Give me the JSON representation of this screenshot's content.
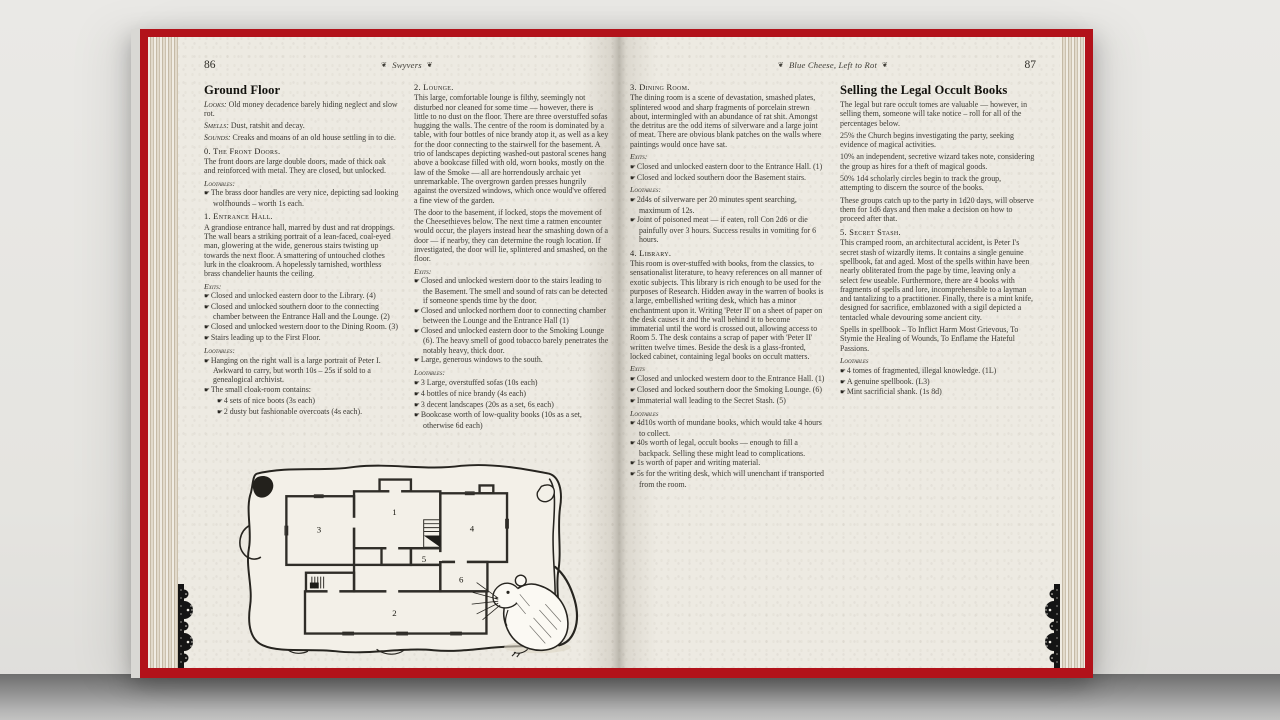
{
  "icons": {
    "bullet": "☛",
    "fleuron": "❦"
  },
  "colors": {
    "cover_red": "#b2121a",
    "paper": "#edeae2",
    "ink": "#3b3933"
  },
  "left_page": {
    "page_number": "86",
    "running_header": "Swyvers",
    "col1": {
      "heading": "Ground Floor",
      "stats": [
        {
          "label": "Looks:",
          "text": " Old money decadence barely hiding neglect and slow rot."
        },
        {
          "label": "Smells:",
          "text": " Dust, ratshit and decay."
        },
        {
          "label": "Sounds:",
          "text": " Creaks and moans of an old house settling in to die."
        }
      ],
      "section0": {
        "title": "0. The Front Doors.",
        "body": "The front doors are large double doors, made of thick oak and reinforced with metal. They are closed, but unlocked."
      },
      "loot0_label": "Lootables:",
      "loot0": [
        "The brass door handles are very nice, depicting sad looking wolfhounds – worth 1s each."
      ],
      "section1": {
        "title": "1. Entrance Hall.",
        "body": "A grandiose entrance hall, marred by dust and rat droppings. The wall bears a striking portrait of a lean-faced, coal-eyed man, glowering at the wide, generous stairs twisting up towards the next floor. A smattering of untouched clothes lurk in the cloakroom. A hopelessly tarnished, worthless brass chandelier haunts the ceiling."
      },
      "exits1_label": "Exits:",
      "exits1": [
        "Closed and unlocked eastern door to the Library. (4)",
        "Closed and unlocked southern door to the connecting chamber between the Entrance Hall and the Lounge. (2)",
        "Closed and unlocked western door to the Dining Room. (3)",
        "Stairs leading up to the First Floor."
      ],
      "loot1_label": "Lootables:",
      "loot1": [
        "Hanging on the right wall is a large portrait of Peter I. Awkward to carry, but worth 10s – 25s if sold to a genealogical archivist.",
        "The small cloak-room contains:"
      ],
      "loot1_sub": [
        "4 sets of nice boots (3s each)",
        "2 dusty but fashionable overcoats (4s each)."
      ]
    },
    "col2": {
      "section2": {
        "title": "2. Lounge.",
        "body1": "This large, comfortable lounge is filthy, seemingly not disturbed nor cleaned for some time — however, there is little to no dust on the floor. There are three overstuffed sofas hugging the walls. The centre of the room is dominated by a table, with four bottles of nice brandy atop it, as well as a key for the door connecting to the stairwell for the basement. A trio of landscapes depicting washed-out pastoral scenes hang above a bookcase filled with old, worn books, mostly on the law of the Smoke — all are horrendously archaic yet unremarkable. The overgrown garden presses hungrily against the oversized windows, which once would've offered a fine view of the garden.",
        "body2": "The door to the basement, if locked, stops the movement of the Cheesethieves below. The next time a ratmen encounter would occur, the players instead hear the smashing down of a door — if nearby, they can determine the rough location. If investigated, the door will lie, splintered and smashed, on the floor."
      },
      "exits2_label": "Exits:",
      "exits2": [
        "Closed and unlocked western door to the stairs leading to the Basement. The smell and sound of rats can be detected if someone spends time by the door.",
        "Closed and unlocked northern door to connecting chamber between the Lounge and the Entrance Hall (1)",
        "Closed and unlocked eastern door to the Smoking Lounge (6). The heavy smell of good tobacco barely penetrates the notably heavy, thick door.",
        "Large, generous windows to the south."
      ],
      "loot2_label": "Lootables:",
      "loot2": [
        "3 Large, overstuffed sofas (10s each)",
        "4 bottles of nice brandy (4s each)",
        "3 decent landscapes (20s as a set, 6s each)",
        "Bookcase worth of low-quality books (10s as a set, otherwise 6d each)"
      ]
    },
    "floorplan": {
      "rooms": [
        "1",
        "2",
        "3",
        "4",
        "5",
        "6"
      ]
    }
  },
  "right_page": {
    "page_number": "87",
    "running_header": "Blue Cheese, Left to Rot",
    "col1": {
      "section3": {
        "title": "3. Dining Room.",
        "body": "The dining room is a scene of devastation, smashed plates, splintered wood and sharp fragments of porcelain strewn about, intermingled with an abundance of rat shit. Amongst the detritus are the odd items of silverware and a large joint of meat. There are obvious blank patches on the walls where paintings would once have sat."
      },
      "exits3_label": "Exits:",
      "exits3": [
        "Closed and unlocked eastern door to the Entrance Hall. (1)",
        "Closed and locked southern door the Basement stairs."
      ],
      "loot3_label": "Lootables:",
      "loot3": [
        "2d4s of silverware per 20 minutes spent searching, maximum of 12s.",
        "Joint of poisoned meat — if eaten, roll Con 2d6 or die painfully over 3 hours. Success results in vomiting for 6 hours."
      ],
      "section4": {
        "title": "4. Library.",
        "body": "This room is over-stuffed with books, from the classics, to sensationalist literature, to heavy references on all manner of exotic subjects. This library is rich enough to be used for the purposes of Research. Hidden away in the warren of books is a large, embellished writing desk, which has a minor enchantment upon it. Writing 'Peter II' on a sheet of paper on the desk causes it and the wall behind it to become immaterial until the word is crossed out, allowing access to Room 5. The desk contains a scrap of paper with 'Peter II' written twelve times. Beside the desk is a glass-fronted, locked cabinet, containing legal books on occult matters."
      },
      "exits4_label": "Exits",
      "exits4": [
        "Closed and unlocked western door to the Entrance Hall. (1)",
        "Closed and locked southern door the Smoking Lounge. (6)",
        "Immaterial wall leading to the Secret Stash. (5)"
      ],
      "loot4_label": "Lootables",
      "loot4": [
        "4d10s worth of mundane books, which would take 4 hours to collect.",
        "40s worth of legal, occult books — enough to fill a backpack. Selling these might lead to complications.",
        "1s worth of paper and writing material.",
        "5s for the writing desk, which will unenchant if transported from the room."
      ]
    },
    "col2": {
      "heading": "Selling the Legal Occult Books",
      "paras": [
        "The legal but rare occult tomes are valuable — however, in selling them, someone will take notice – roll for all of the percentages below.",
        "25% the Church begins investigating the party, seeking evidence of magical activities.",
        "10% an independent, secretive wizard takes note, considering the group as hires for a theft of magical goods.",
        "50% 1d4 scholarly circles begin to track the group, attempting to discern the source of the books.",
        "These groups catch up to the party in 1d20 days, will observe them for 1d6 days and then make a decision on how to proceed after that."
      ],
      "section5": {
        "title": "5. Secret Stash.",
        "body": "This cramped room, an architectural accident, is Peter I's secret stash of wizardly items. It contains a single genuine spellbook, fat and aged. Most of the spells within have been nearly obliterated from the page by time, leaving only a select few useable. Furthermore, there are 4 books with fragments of spells and lore, incomprehensible to a layman and tantalizing to a practitioner. Finally, there is a mint knife, designed for sacrifice, emblazoned with a sigil depicted a tentacled whale devouring some ancient city."
      },
      "spells_para": "Spells in spellbook – To Inflict Harm Most Grievous, To Stymie the Healing of Wounds, To Enflame the Hateful Passions.",
      "loot5_label": "Lootables",
      "loot5": [
        "4 tomes of fragmented, illegal knowledge. (1L)",
        "A genuine spellbook. (L3)",
        "Mint sacrificial shank. (1s 8d)"
      ]
    }
  }
}
